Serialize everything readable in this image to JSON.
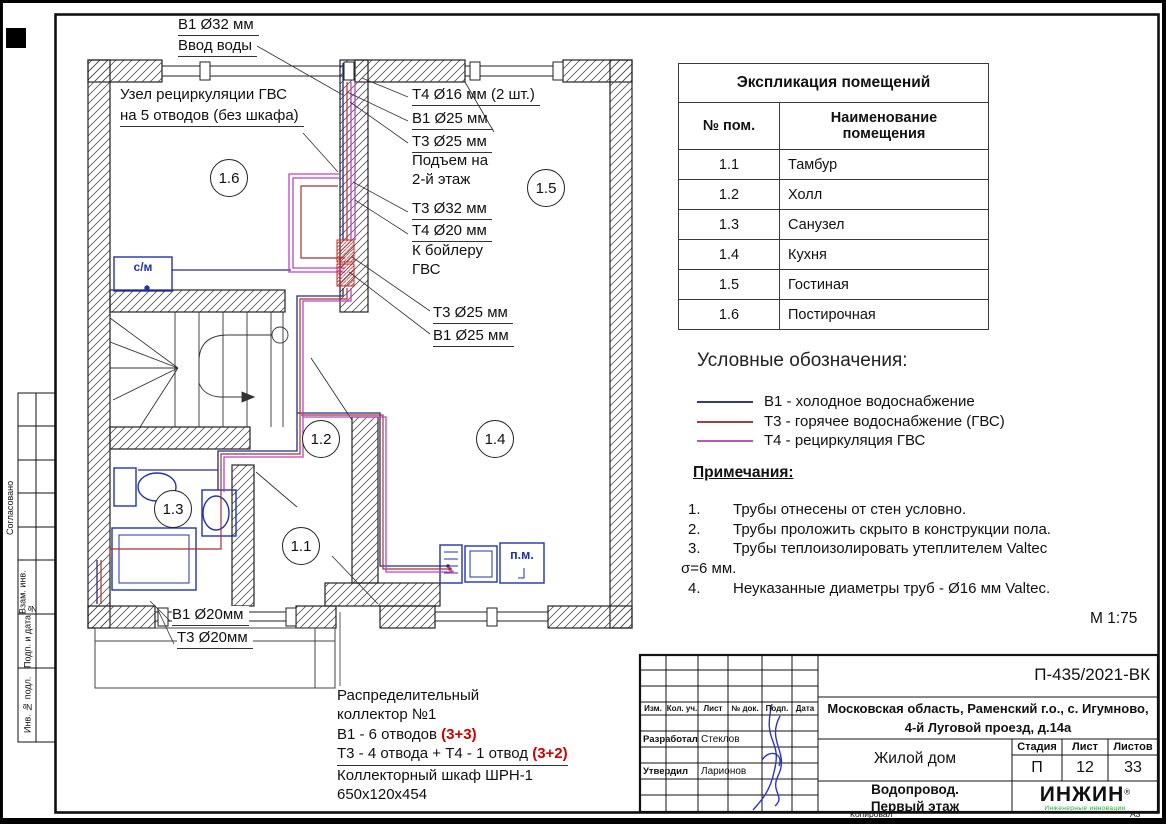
{
  "sheet": {
    "scale": "М 1:75",
    "copied_label": "Копировал",
    "format_label": "А3"
  },
  "plan": {
    "callouts": {
      "inlet_pipe": "В1 Ø32 мм",
      "inlet_caption": "Ввод воды",
      "recirc_line1": "Узел рециркуляции ГВС",
      "recirc_line2": "на 5 отводов (без шкафа)",
      "t4_16": "Т4 Ø16 мм (2 шт.)",
      "b1_25_top": "В1 Ø25 мм",
      "t3_25_top": "Т3 Ø25 мм",
      "rise_line1": "Подъем на",
      "rise_line2": "2-й этаж",
      "t3_32": "Т3 Ø32 мм",
      "t4_20": "Т4 Ø20 мм",
      "boiler_line1": "К бойлеру",
      "boiler_line2": "ГВС",
      "t3_25_mid": "Т3 Ø25 мм",
      "b1_25_mid": "В1 Ø25 мм",
      "b1_20": "В1 Ø20мм",
      "t3_20": "Т3 Ø20мм",
      "washing_machine": "с/м",
      "dishwasher": "п.м."
    },
    "rooms": [
      "1.6",
      "1.5",
      "1.2",
      "1.4",
      "1.3",
      "1.1"
    ],
    "collector_note": {
      "line1": "Распределительный",
      "line2": "коллектор №1",
      "line3": "В1 - 6 отводов ",
      "line3_red": "(3+3)",
      "line4": "Т3 - 4 отвода + Т4 - 1 отвод ",
      "line4_red": "(3+2)",
      "line5": "Коллекторный шкаф ШРН-1",
      "line6": "650х120х454"
    },
    "pipe_colors": {
      "b1": "#2a2a80",
      "t3": "#a83232",
      "t4": "#bb44bb"
    },
    "fixture_color": "#2233aa",
    "red_note_color": "#cc0000"
  },
  "explication": {
    "title": "Экспликация помещений",
    "col_num": "№ пом.",
    "col_name": "Наименование помещения",
    "rows": [
      {
        "num": "1.1",
        "name": "Тамбур"
      },
      {
        "num": "1.2",
        "name": "Холл"
      },
      {
        "num": "1.3",
        "name": "Санузел"
      },
      {
        "num": "1.4",
        "name": "Кухня"
      },
      {
        "num": "1.5",
        "name": "Гостиная"
      },
      {
        "num": "1.6",
        "name": "Постирочная"
      }
    ]
  },
  "legend": {
    "title": "Условные обозначения:",
    "items": [
      {
        "label": "В1 - холодное водоснабжение",
        "color": "#3a3a72"
      },
      {
        "label": "Т3 - горячее водоснабжение (ГВС)",
        "color": "#a04040"
      },
      {
        "label": "Т4 - рециркуляция ГВС",
        "color": "#bb55bb"
      }
    ]
  },
  "notes": {
    "title": "Примечания:",
    "items": [
      {
        "num": "1.",
        "text": "Трубы отнесены от стен условно."
      },
      {
        "num": "2.",
        "text": "Трубы проложить скрыто в конструкции пола."
      },
      {
        "num": "3.",
        "text": "Трубы теплоизолировать утеплителем Valtec σ=6 мм."
      },
      {
        "num": "4.",
        "text": "Неуказанные диаметры труб - Ø16 мм Valtec."
      }
    ]
  },
  "stamp": {
    "doc_number": "П-435/2021-ВК",
    "address_line1": "Московская область, Раменский г.о., с. Игумново,",
    "address_line2": "4-й Луговой проезд, д.14а",
    "object_name": "Жилой дом",
    "sheet_name_line1": "Водопровод.",
    "sheet_name_line2": "Первый этаж",
    "header_cols": [
      "Изм.",
      "Кол. уч.",
      "Лист",
      "№ док.",
      "Подп.",
      "Дата"
    ],
    "developed_label": "Разработал",
    "developed_name": "Стеклов",
    "approved_label": "Утвердил",
    "approved_name": "Ларионов",
    "stage_label": "Стадия",
    "sheet_label": "Лист",
    "sheets_label": "Листов",
    "stage_value": "П",
    "sheet_value": "12",
    "sheets_value": "33",
    "logo_text": "ИНЖИН",
    "logo_reg": "®",
    "logo_tagline": "Инженерные инновации",
    "logo_green": "#2e9e3a"
  },
  "side_strip": {
    "agreed": "Согласовано",
    "vzam": "Взам. инв. №",
    "podp": "Подп. и дата",
    "inv": "Инв. № подл."
  }
}
